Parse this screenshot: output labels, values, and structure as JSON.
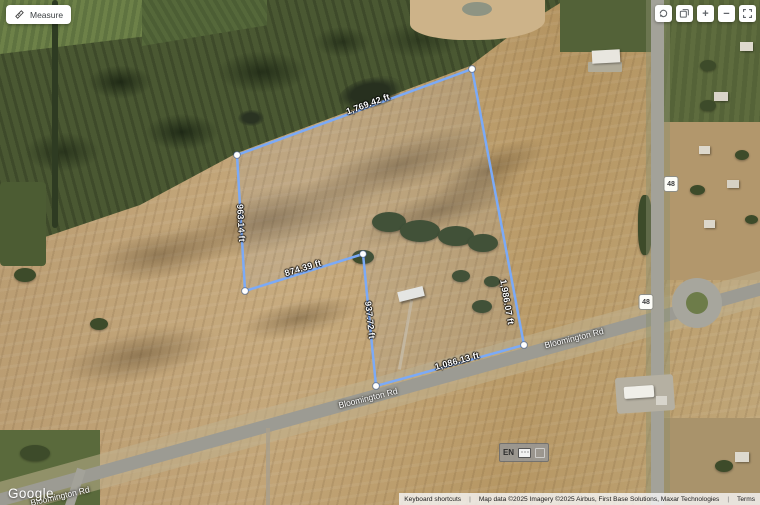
{
  "colors": {
    "measure_line": "#7baaf7",
    "vertex": "#ffffff",
    "field_tan": "#b5976c",
    "forest_green": "#4a5832",
    "road_gray": "#a3a299",
    "control_icon": "#5f6368"
  },
  "measure_tool": {
    "label": "Measure"
  },
  "map_controls": {
    "zoom_in_glyph": "+",
    "zoom_out_glyph": "−"
  },
  "measurement": {
    "segments": [
      {
        "label": "1,769.42 ft"
      },
      {
        "label": "1,986.07 ft"
      },
      {
        "label": "1,086.13 ft"
      },
      {
        "label": "937.72 ft"
      },
      {
        "label": "874.39 ft"
      },
      {
        "label": "963.14 ft"
      }
    ]
  },
  "roads": {
    "bloomington": "Bloomington Rd",
    "route_shield": "48"
  },
  "input_indicator": {
    "language": "EN"
  },
  "footer": {
    "google": "Google",
    "keyboard_shortcuts": "Keyboard shortcuts",
    "map_data": "Map data ©2025  Imagery ©2025 Airbus, First Base Solutions, Maxar Technologies",
    "terms": "Terms"
  }
}
